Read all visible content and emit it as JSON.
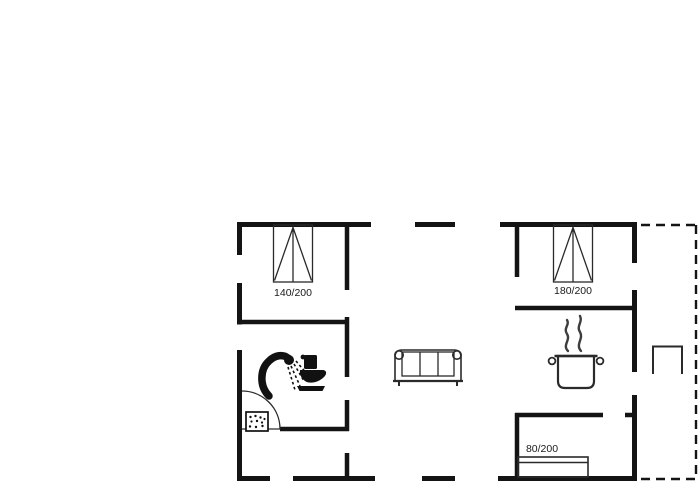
{
  "floorplan": {
    "bed_labels": {
      "double_left": "140/200",
      "double_right": "180/200",
      "single_bottom": "80/200"
    },
    "colors": {
      "walls": "#141414",
      "thin_lines": "#2a2a2a",
      "fixtures": "#111111",
      "steam": "#3d3d3d",
      "background": "#ffffff"
    }
  }
}
